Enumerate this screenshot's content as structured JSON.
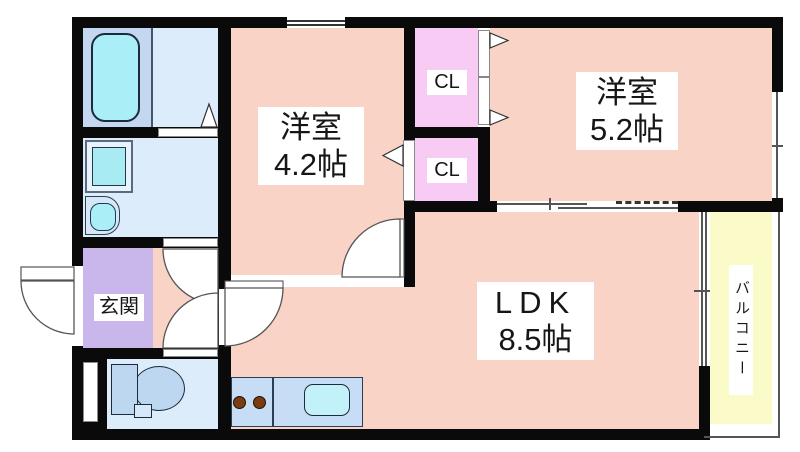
{
  "rooms": {
    "western_room_1": {
      "name": "洋室",
      "size": "4.2帖"
    },
    "western_room_2": {
      "name": "洋室",
      "size": "5.2帖"
    },
    "ldk": {
      "name": "LDK",
      "size": "8.5帖"
    },
    "closet_upper": {
      "label": "CL"
    },
    "closet_lower": {
      "label": "CL"
    },
    "entrance": {
      "label": "玄関"
    },
    "balcony": {
      "label": "バルコニー"
    }
  },
  "fixtures": [
    "bathtub",
    "washing-machine",
    "washbasin",
    "toilet",
    "kitchen-counter",
    "gas-burners",
    "kitchen-sink"
  ],
  "colors": {
    "wall": "#0a0a0a",
    "room_pink": "#f9d3c5",
    "closet_pink": "#f8cbf4",
    "entrance_purple": "#c9b6eb",
    "wet_area_blue": "#ddecfa",
    "bath_floor_blue": "#c3d7f0",
    "fixture_cyan": "#aaeef8",
    "fixture_blue": "#bdd7f1",
    "counter_blue": "#c7ddf5",
    "balcony_yellow": "#fbfbca",
    "burner_brown": "#7b3c12"
  }
}
